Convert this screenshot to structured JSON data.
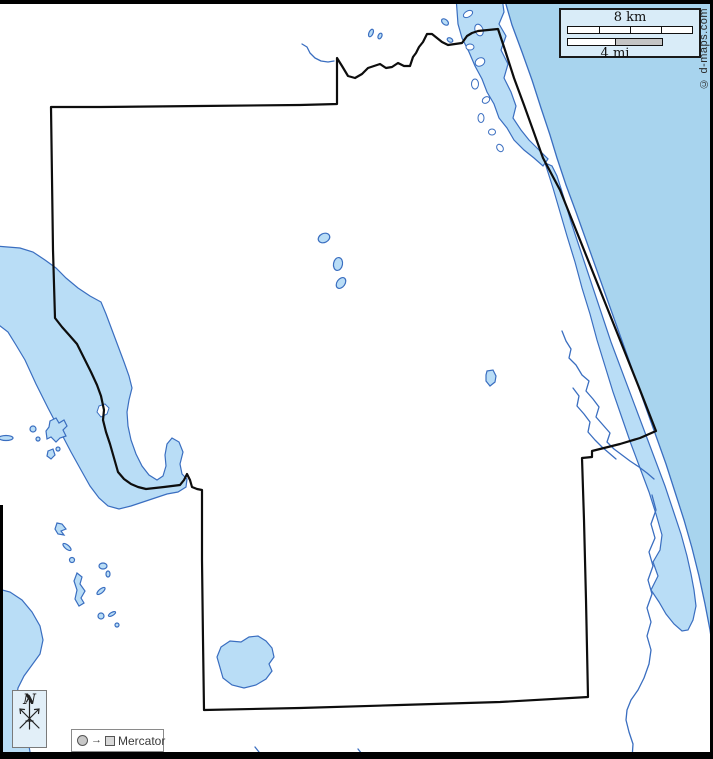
{
  "map": {
    "kind": "county-outline-map",
    "labels": {
      "scale_km": "8 km",
      "scale_mi": "4 mi",
      "north": "N",
      "projection": "Mercator",
      "projection_arrow": "→",
      "watermark": "© d-maps.com"
    }
  },
  "colors": {
    "water_fill": "#b9ddf6",
    "water_stroke": "#3a6ec0",
    "ocean_fill": "#a8d4ee",
    "boundary": "#0d0d0d",
    "frame": "#000000",
    "scale_box_fill": "#d9ecf8",
    "box_border": "#7a7a7a",
    "label_text": "#2a2a2a"
  }
}
